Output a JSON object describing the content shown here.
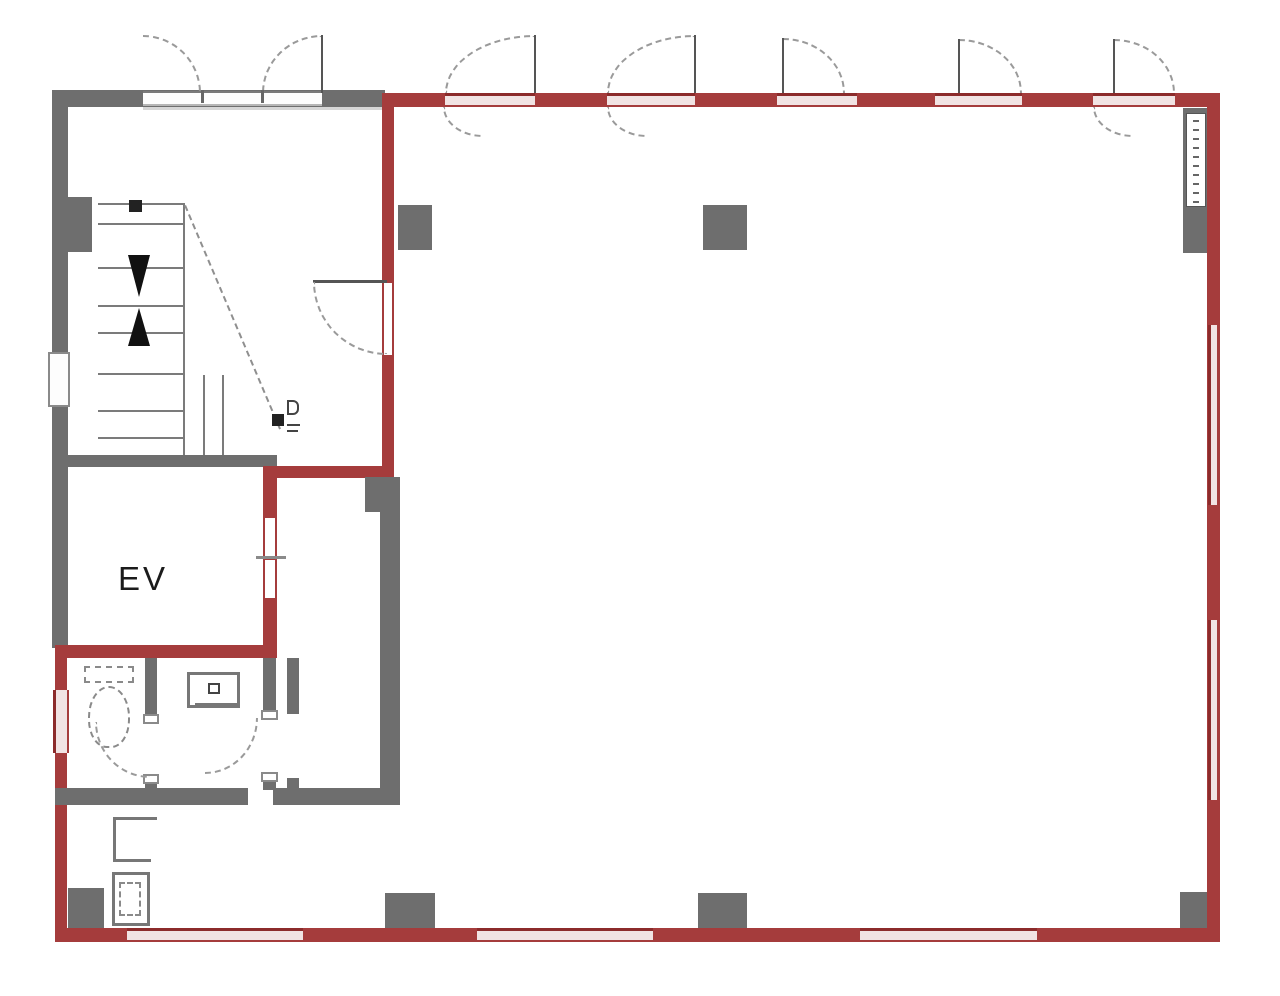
{
  "plan": {
    "labels": {
      "elevator": "EV"
    },
    "colors": {
      "lease_boundary_red": "#a53c3c",
      "lease_boundary_red_dark": "#8c2b2b",
      "wall_gray": "#6e6e6e"
    },
    "legend": {
      "red_outline_meaning": "leased-area boundary",
      "gray_meaning": "structural walls and columns"
    }
  }
}
